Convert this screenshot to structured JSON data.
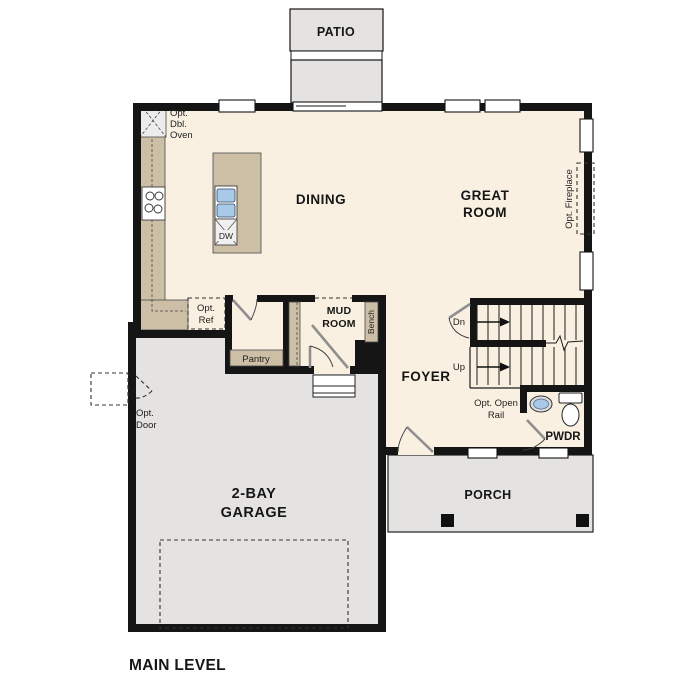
{
  "title": "MAIN LEVEL",
  "colors": {
    "wall": "#151515",
    "floor": "#f9f0e1",
    "hard_surface": "#e4e3e1",
    "counter": "#cdbfa6",
    "appliance_gray": "#ececec",
    "sink_blue": "#a9c9e8",
    "window_white": "#ffffff"
  },
  "labels": {
    "patio": "PATIO",
    "dining": "DINING",
    "great_room": [
      "GREAT",
      "ROOM"
    ],
    "opt_dbl_oven": [
      "Opt.",
      "Dbl.",
      "Oven"
    ],
    "dw": "DW",
    "opt_fireplace": "Opt. Fireplace",
    "opt_ref": [
      "Opt.",
      "Ref"
    ],
    "pantry": "Pantry",
    "mud_room": [
      "MUD",
      "ROOM"
    ],
    "bench": "Bench",
    "stairs_down": "Dn",
    "stairs_up": "Up",
    "foyer": "FOYER",
    "opt_open_rail": [
      "Opt. Open",
      "Rail"
    ],
    "pwdr": "PWDR",
    "opt_door": [
      "Opt.",
      "Door"
    ],
    "garage": [
      "2-BAY",
      "GARAGE"
    ],
    "porch": "PORCH",
    "main_level": "MAIN LEVEL"
  }
}
